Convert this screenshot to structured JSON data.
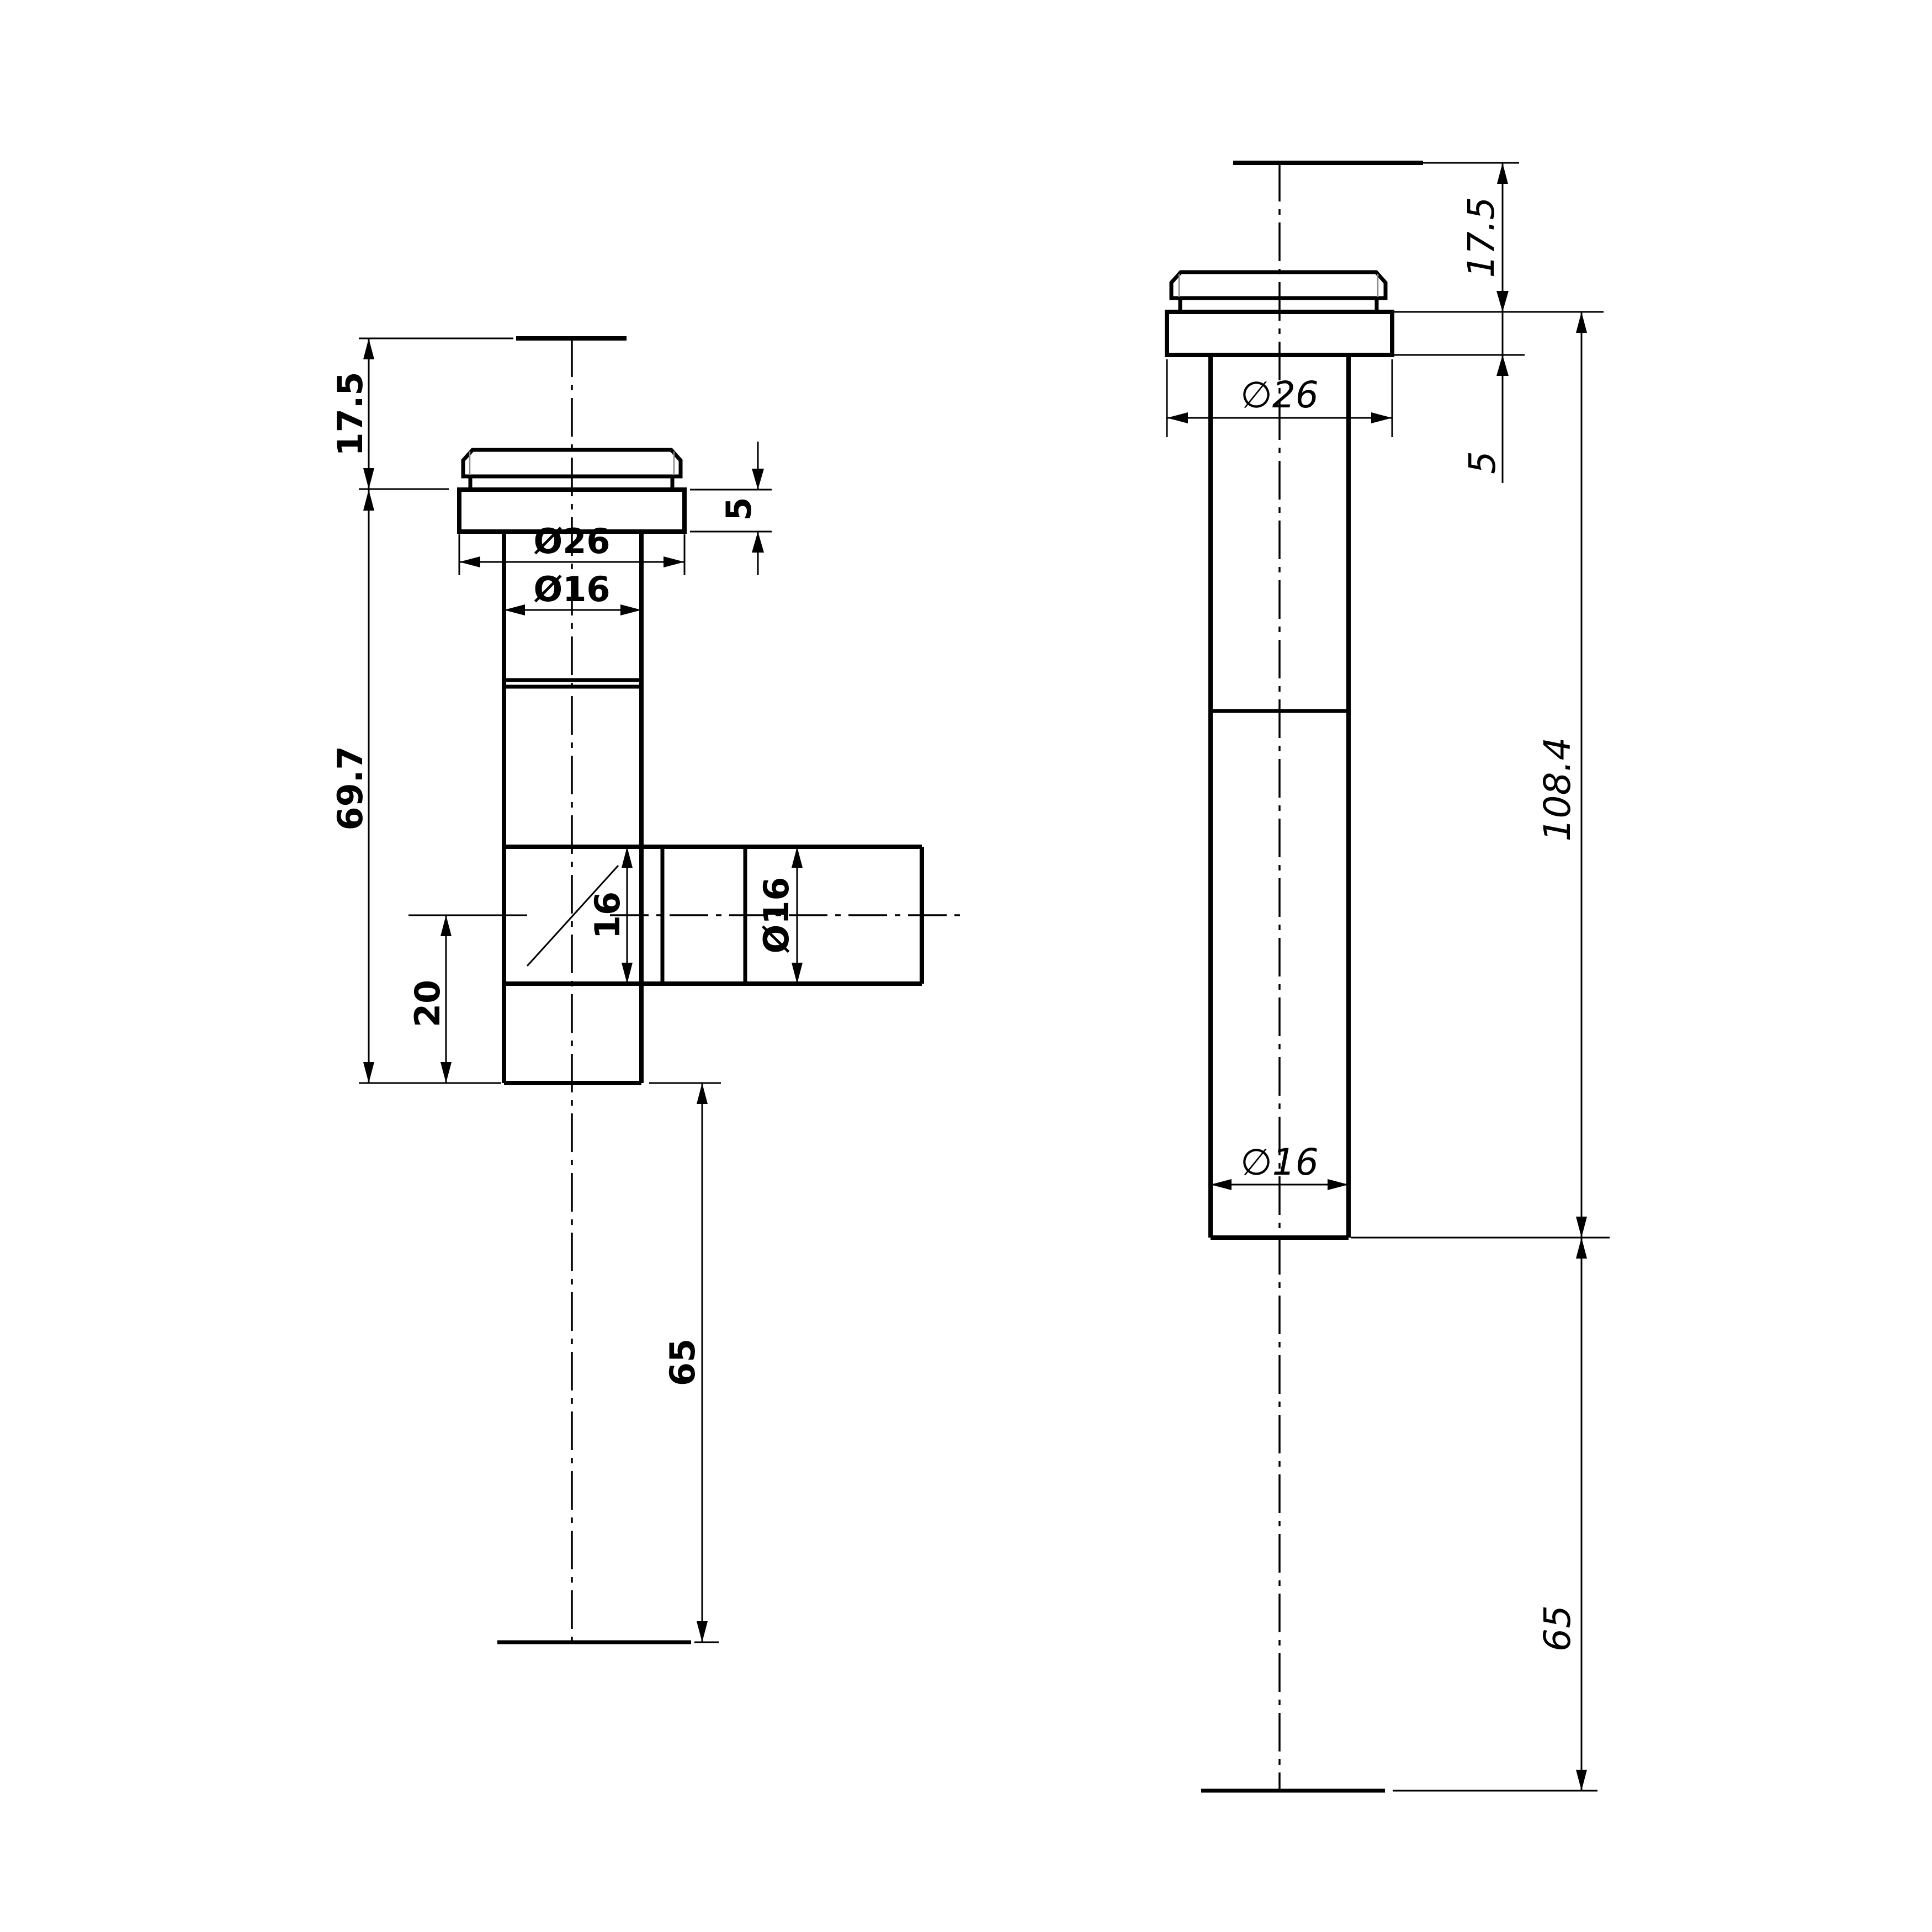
{
  "drawing": {
    "type": "technical-drawing",
    "colors": {
      "background": "#ffffff",
      "lines": "#000000",
      "chamfer_lines": "#8a8a8a"
    },
    "left_view": {
      "description": "front view of tee-shaped fitting with side branch",
      "labels": {
        "top_height": "17.5",
        "flange_thickness": "5",
        "flange_diameter": "Ø26",
        "shaft_diameter": "Ø16",
        "body_length": "69.7",
        "branch_width": "16",
        "branch_diameter": "Ø16",
        "branch_offset": "20",
        "tail_length": "65"
      }
    },
    "right_view": {
      "description": "side view of straight fitting body",
      "labels": {
        "top_height": "17.5",
        "flange_thickness": "5",
        "flange_diameter": "∅26",
        "total_length": "108.4",
        "shaft_diameter": "∅16",
        "tail_length": "65"
      }
    }
  }
}
